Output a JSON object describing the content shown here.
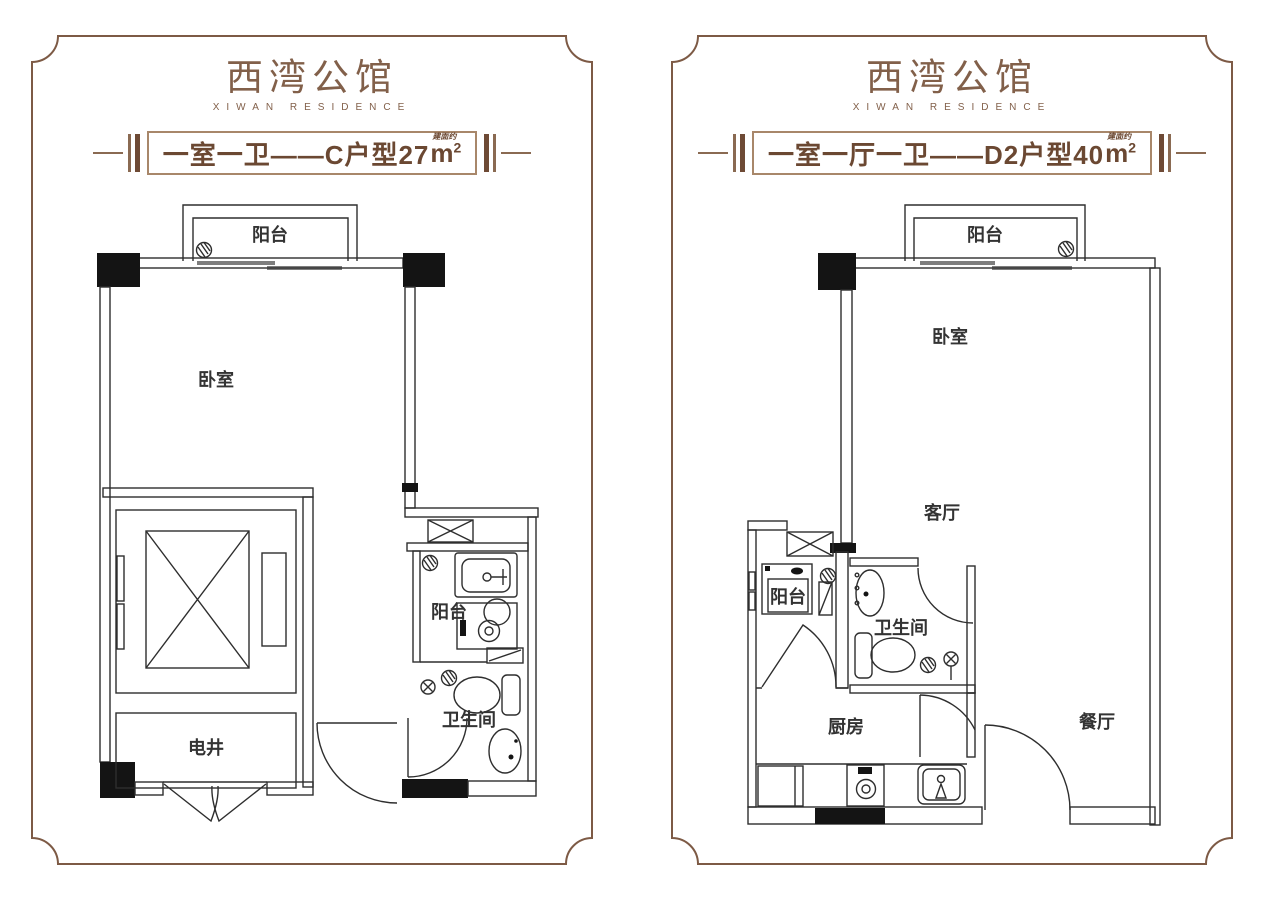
{
  "colors": {
    "frame": "#7d5a45",
    "brand_text": "#82604a",
    "banner_text": "#6b4832",
    "banner_border": "#a8876a",
    "plan_line": "#2e2e2e",
    "wall_fill": "#141414"
  },
  "panels": [
    {
      "brand_title": "西湾公馆",
      "brand_subtitle": "XIWAN RESIDENCE",
      "banner": {
        "text": "一室一卫——C户型27",
        "area_note": "建面约",
        "area_unit": "m",
        "area_power": "2"
      },
      "rooms": {
        "balcony": "阳台",
        "bedroom": "卧室",
        "shaft": "电井",
        "utility_balcony": "阳台",
        "bathroom": "卫生间"
      }
    },
    {
      "brand_title": "西湾公馆",
      "brand_subtitle": "XIWAN RESIDENCE",
      "banner": {
        "text": "一室一厅一卫——D2户型40",
        "area_note": "建面约",
        "area_unit": "m",
        "area_power": "2"
      },
      "rooms": {
        "balcony": "阳台",
        "bedroom": "卧室",
        "living": "客厅",
        "service_balcony": "阳台",
        "bathroom": "卫生间",
        "kitchen": "厨房",
        "dining": "餐厅"
      }
    }
  ]
}
